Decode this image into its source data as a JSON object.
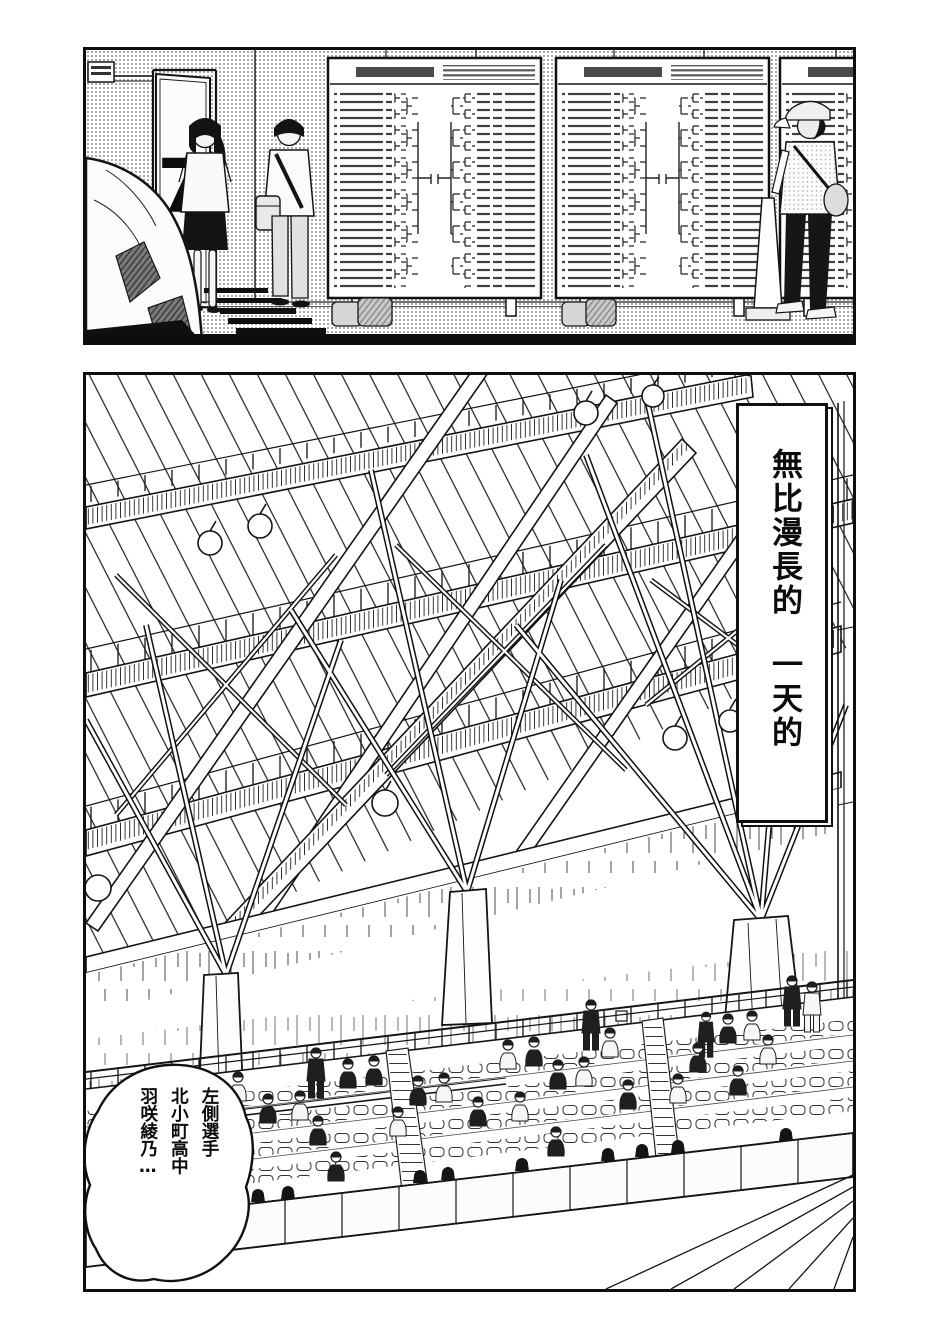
{
  "meta": {
    "type": "manga-page",
    "panel_count": 2
  },
  "colors": {
    "ink": "#141414",
    "paper": "#ffffff",
    "halftone_dot": "#a9a9a9"
  },
  "top_panel": {
    "scene": "hallway-with-tournament-bracket-boards",
    "door_sign": "7"
  },
  "bottom_panel": {
    "scene": "gymnasium-ceiling-and-spectator-stands",
    "caption_box": {
      "text": "無比漫長的一天的",
      "segments": [
        "無比漫長的",
        "一天的"
      ]
    },
    "speech_bubble": {
      "lines": [
        "左側選手",
        "北小町高中",
        "羽咲綾乃…"
      ]
    }
  }
}
